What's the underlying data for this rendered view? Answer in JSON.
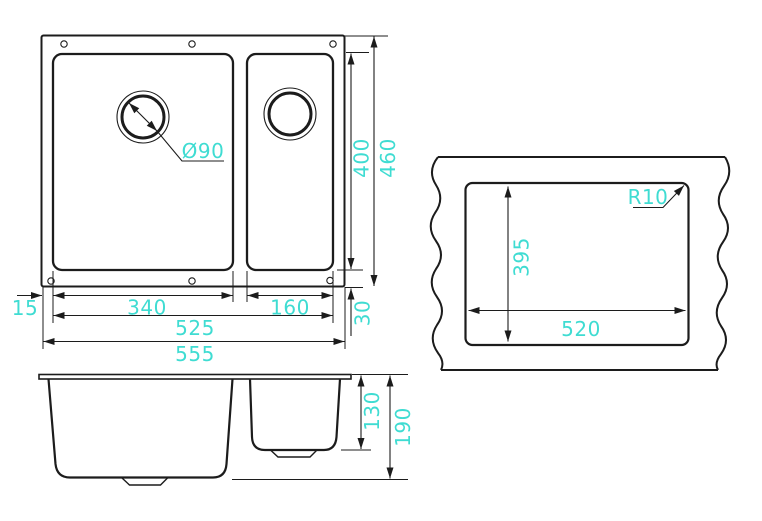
{
  "drawing_title": "sink-technical-drawing",
  "colors": {
    "dimension_text": "#3FDCD2",
    "line": "#1c1c1c",
    "background": "#ffffff"
  },
  "top_view": {
    "dim_drain_diameter": "Ø90",
    "dim_inner_height": "400",
    "dim_overall_height": "460",
    "dim_edge_offset": "15",
    "dim_main_bowl_width": "340",
    "dim_half_bowl_width": "160",
    "dim_inner_width": "525",
    "dim_overall_width": "555",
    "dim_bottom_offset": "30"
  },
  "cutout_view": {
    "dim_corner_radius": "R10",
    "dim_cutout_height": "395",
    "dim_cutout_width": "520"
  },
  "side_view": {
    "dim_half_bowl_depth": "130",
    "dim_main_bowl_depth": "190"
  }
}
